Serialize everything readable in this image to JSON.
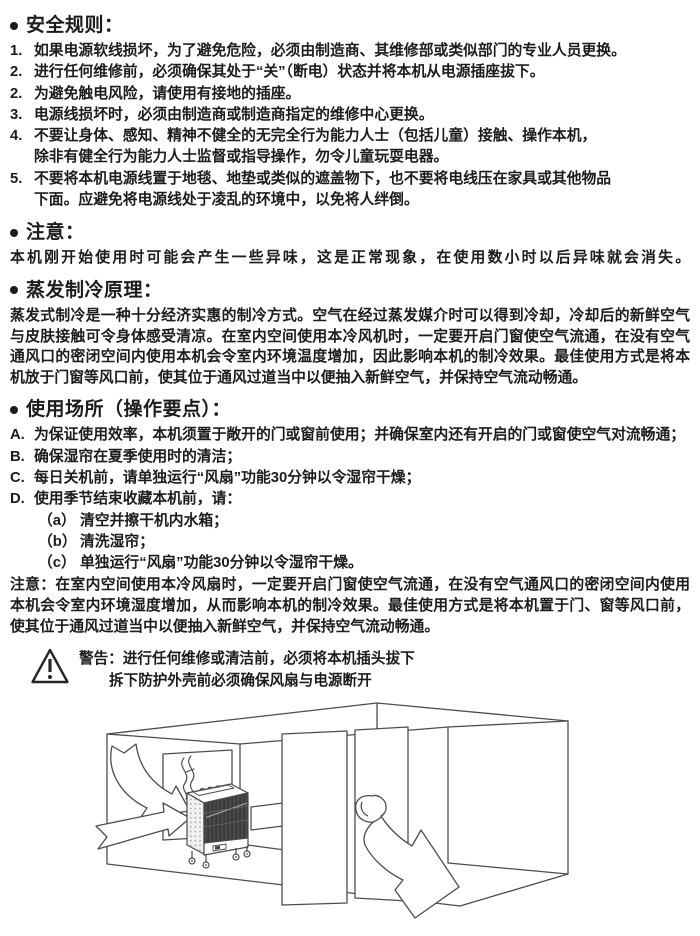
{
  "bullet_symbol": "•",
  "colors": {
    "text": "#1c1c1c",
    "background": "#ffffff",
    "diagram_line": "#4d4d4d",
    "cooler_grille": "#3b3b3b"
  },
  "safety": {
    "heading": "安全规则：",
    "items": [
      {
        "num": "1.",
        "text": "如果电源软线损坏，为了避免危险，必须由制造商、其维修部或类似部门的专业人员更换。"
      },
      {
        "num": "2.",
        "text": "进行任何维修前，必须确保其处于“关”（断电）状态并将本机从电源插座拔下。"
      },
      {
        "num": "2.",
        "text": "为避免触电风险，请使用有接地的插座。"
      },
      {
        "num": "3.",
        "text": "电源线损坏时，必须由制造商或制造商指定的维修中心更换。"
      },
      {
        "num": "4.",
        "text": "不要让身体、感知、精神不健全的无完全行为能力人士（包括儿童）接触、操作本机，\n除非有健全行为能力人士监督或指导操作，勿令儿童玩耍电器。"
      },
      {
        "num": "5.",
        "text": "不要将本机电源线置于地毯、地垫或类似的遮盖物下，也不要将电线压在家具或其他物品\n下面。应避免将电源线处于凌乱的环境中，以免将人绊倒。"
      }
    ]
  },
  "attention": {
    "heading": "注意：",
    "body": "本机刚开始使用时可能会产生一些异味，这是正常现象，在使用数小时以后异味就会消失。"
  },
  "principle": {
    "heading": "蒸发制冷原理：",
    "body": "蒸发式制冷是一种十分经济实惠的制冷方式。空气在经过蒸发媒介时可以得到冷却，冷却后的新鲜空气与皮肤接触可令身体感受清凉。在室内空间使用本冷风机时，一定要开启门窗使空气流通，在没有空气通风口的密闭空间内使用本机会令室内环境温度增加，因此影响本机的制冷效果。最佳使用方式是将本机放于门窗等风口前，使其位于通风过道当中以便抽入新鲜空气，并保持空气流动畅通。"
  },
  "usage": {
    "heading": "使用场所（操作要点）：",
    "items": [
      {
        "num": "A.",
        "text": "为保证使用效率，本机须置于敞开的门或窗前使用；并确保室内还有开启的门或窗使空气对流畅通；"
      },
      {
        "num": "B.",
        "text": "确保湿帘在夏季使用时的清洁；"
      },
      {
        "num": "C.",
        "text": "每日关机前，请单独运行“风扇”功能30分钟以令湿帘干燥；"
      },
      {
        "num": "D.",
        "text": "使用季节结束收藏本机前，请："
      }
    ],
    "sub_items": [
      {
        "num": "（a）",
        "text": "清空并擦干机内水箱；"
      },
      {
        "num": "（b）",
        "text": "清洗湿帘；"
      },
      {
        "num": "（c）",
        "text": "单独运行“风扇”功能30分钟以令湿帘干燥。"
      }
    ],
    "note": "注意：在室内空间使用本冷风扇时，一定要开启门窗使空气流通，在没有空气通风口的密闭空间内使用本机会令室内环境湿度增加，从而影响本机的制冷效果。最佳使用方式是将本机置于门、窗等风口前，使其位于通风过道当中以便抽入新鲜空气，并保持空气流动畅通。"
  },
  "warning": {
    "label": "警告：",
    "line1": "进行任何维修或清洁前，必须将本机插头拔下",
    "line2": "拆下防护外壳前必须确保风扇与电源断开"
  }
}
